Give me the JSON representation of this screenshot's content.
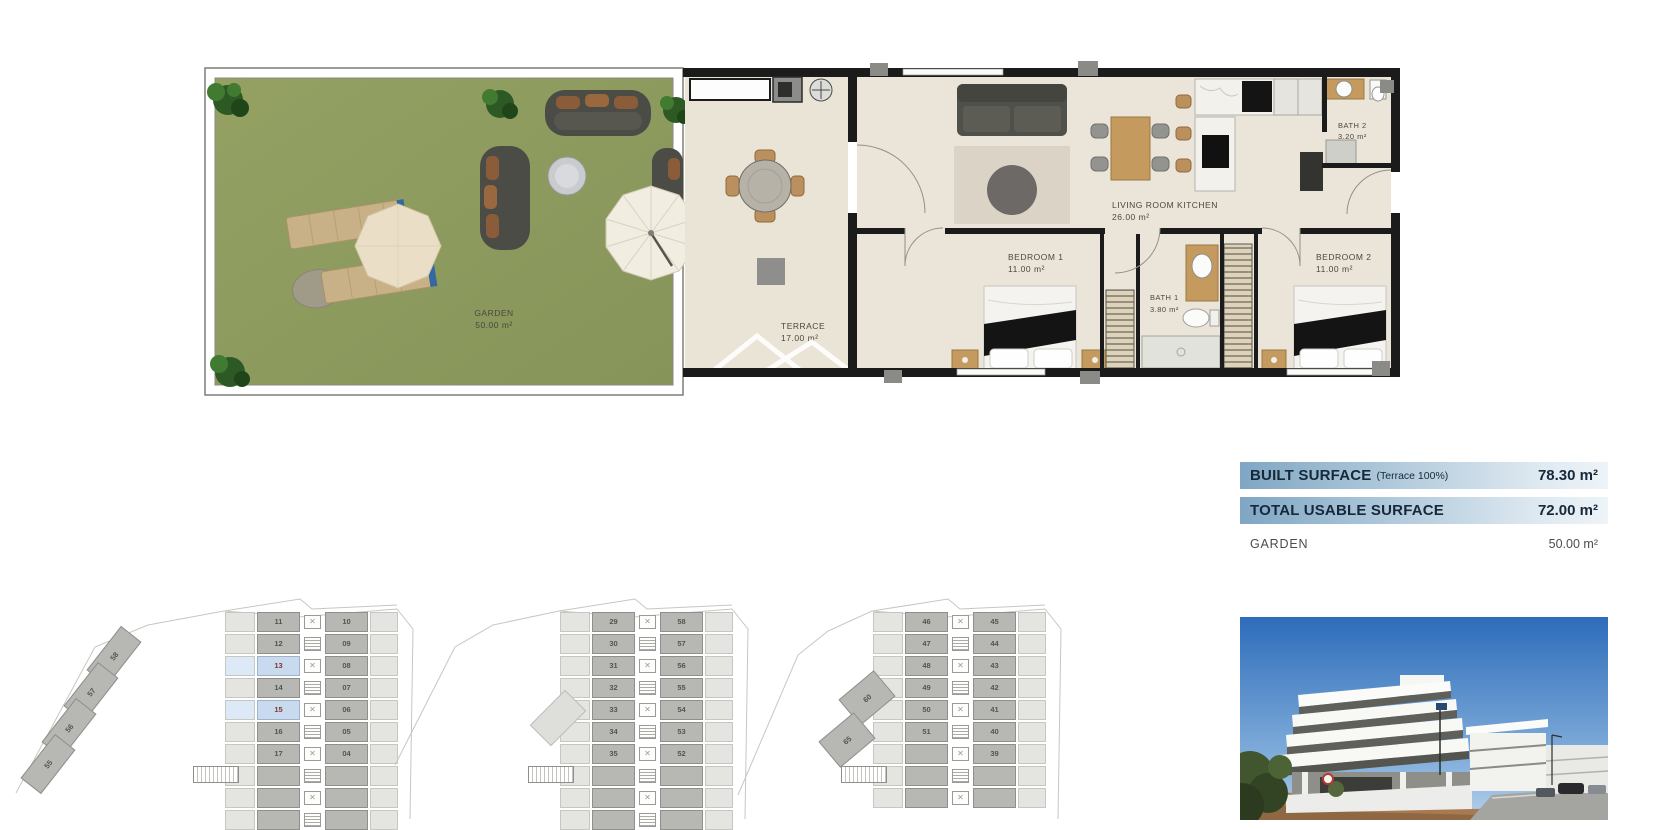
{
  "page": {
    "background": "#ffffff"
  },
  "floorplan": {
    "labels": {
      "garden": {
        "name": "GARDEN",
        "area": "50.00 m²"
      },
      "terrace": {
        "name": "TERRACE",
        "area": "17.00 m²"
      },
      "living": {
        "name": "LIVING ROOM KITCHEN",
        "area": "26.00 m²"
      },
      "bedroom1": {
        "name": "BEDROOM 1",
        "area": "11.00 m²"
      },
      "bath1": {
        "name": "BATH 1",
        "area": "3.80 m²"
      },
      "bedroom2": {
        "name": "BEDROOM 2",
        "area": "11.00 m²"
      },
      "bath2": {
        "name": "BATH 2",
        "area": "3.20 m²"
      }
    },
    "colors": {
      "grass": "#8d9b5d",
      "floor": "#eae5d8",
      "wall": "#1b1b1b",
      "wood": "#c59a5f"
    }
  },
  "surface_table": {
    "rows": [
      {
        "label": "BUILT SURFACE",
        "note": "(Terrace 100%)",
        "value": "78.30 m²",
        "highlight": true
      },
      {
        "label": "TOTAL USABLE SURFACE",
        "note": "",
        "value": "72.00 m²",
        "highlight": true
      },
      {
        "label": "GARDEN",
        "note": "",
        "value": "50.00 m²",
        "highlight": false
      }
    ],
    "accent_start": "#7fa6c3",
    "accent_end": "#eef4f8",
    "text_color": "#16283a"
  },
  "site_plans": [
    {
      "name": "site-plan-1",
      "rows": [
        {
          "left": "11",
          "right": "10"
        },
        {
          "left": "12",
          "right": "09"
        },
        {
          "left": "13",
          "right": "08",
          "highlight_left": true
        },
        {
          "left": "14",
          "right": "07"
        },
        {
          "left": "15",
          "right": "06",
          "highlight_left": true
        },
        {
          "left": "16",
          "right": "05"
        },
        {
          "left": "17",
          "right": "04"
        },
        {
          "left": "",
          "right": ""
        },
        {
          "left": "",
          "right": ""
        },
        {
          "left": "",
          "right": ""
        }
      ],
      "wing": [
        "58",
        "57",
        "56",
        "55"
      ]
    },
    {
      "name": "site-plan-2",
      "rows": [
        {
          "left": "29",
          "right": "58"
        },
        {
          "left": "30",
          "right": "57"
        },
        {
          "left": "31",
          "right": "56"
        },
        {
          "left": "32",
          "right": "55"
        },
        {
          "left": "33",
          "right": "54"
        },
        {
          "left": "34",
          "right": "53"
        },
        {
          "left": "35",
          "right": "52"
        },
        {
          "left": "",
          "right": ""
        },
        {
          "left": "",
          "right": ""
        },
        {
          "left": "",
          "right": ""
        }
      ],
      "wing": []
    },
    {
      "name": "site-plan-3",
      "rows": [
        {
          "left": "46",
          "right": "45"
        },
        {
          "left": "47",
          "right": "44"
        },
        {
          "left": "48",
          "right": "43"
        },
        {
          "left": "49",
          "right": "42"
        },
        {
          "left": "50",
          "right": "41"
        },
        {
          "left": "51",
          "right": "40"
        },
        {
          "left": "",
          "right": "39"
        },
        {
          "left": "",
          "right": ""
        },
        {
          "left": "",
          "right": ""
        }
      ],
      "wing": [
        "60",
        "65"
      ]
    }
  ],
  "photo": {
    "sky_color": "#3a76c0"
  }
}
